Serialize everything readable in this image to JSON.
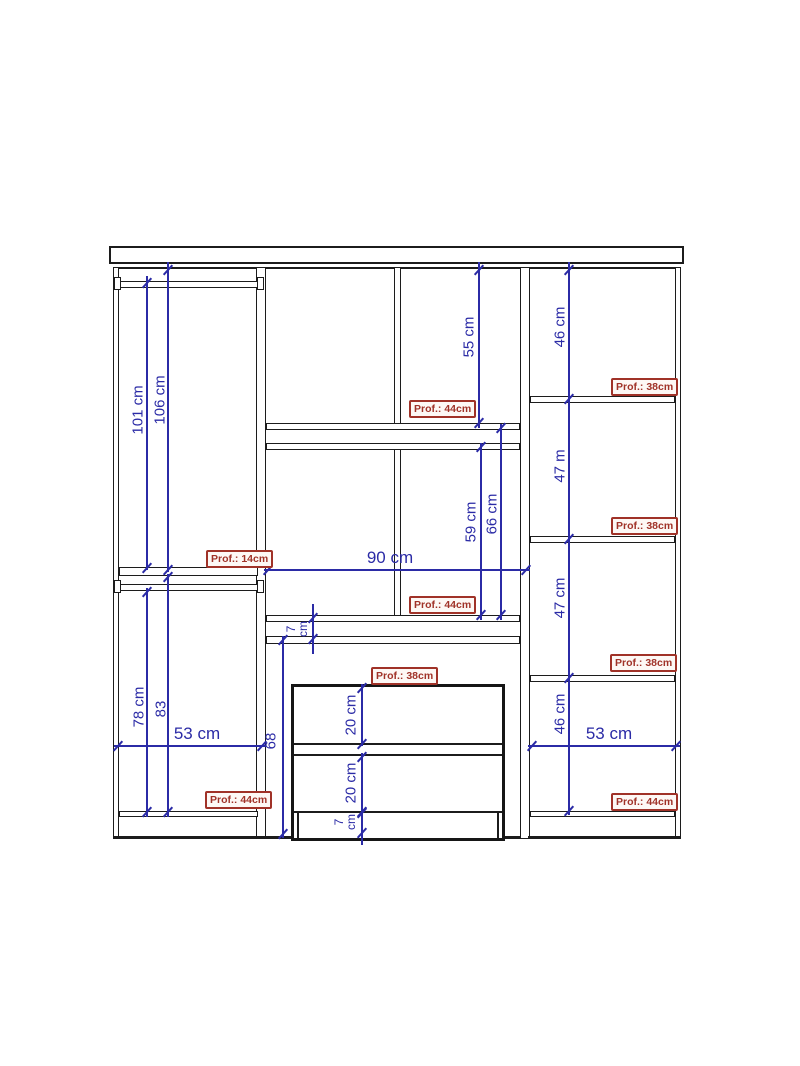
{
  "drawing": {
    "type": "wardrobe-technical-drawing",
    "colors": {
      "dimension_blue": "#2b2ba6",
      "depth_label_red": "#a03228",
      "outline_black": "#1c1c1c",
      "background": "#ffffff"
    },
    "vertical_dims": {
      "left_rod_upper": "101 cm",
      "left_top_upper": "106 cm",
      "left_rod_lower": "78 cm",
      "left_shelf_lower": "83",
      "mid_top_shelf": "55 cm",
      "mid_shelf_inner": "59 cm",
      "mid_shelf_outer": "66 cm",
      "mid_shelf_thickness": "7 cm",
      "dresser_zone": "68",
      "drawer_top": "20 cm",
      "drawer_bottom": "20 cm",
      "plinth": "7 cm",
      "right_sec1": "46 cm",
      "right_sec2": "47 m",
      "right_sec3": "47 cm",
      "right_sec4": "46 cm"
    },
    "horizontal_dims": {
      "left_width": "53 cm",
      "mid_width": "90 cm",
      "right_width": "53 cm"
    },
    "depth_labels": {
      "left_shelf": "Prof.: 14cm",
      "left_base": "Prof.: 44cm",
      "mid_upper": "Prof.: 44cm",
      "mid_lower": "Prof.: 44cm",
      "dresser": "Prof.: 38cm",
      "right_sec1": "Prof.: 38cm",
      "right_sec2": "Prof.: 38cm",
      "right_sec3": "Prof.: 38cm",
      "right_base": "Prof.: 44cm"
    }
  }
}
